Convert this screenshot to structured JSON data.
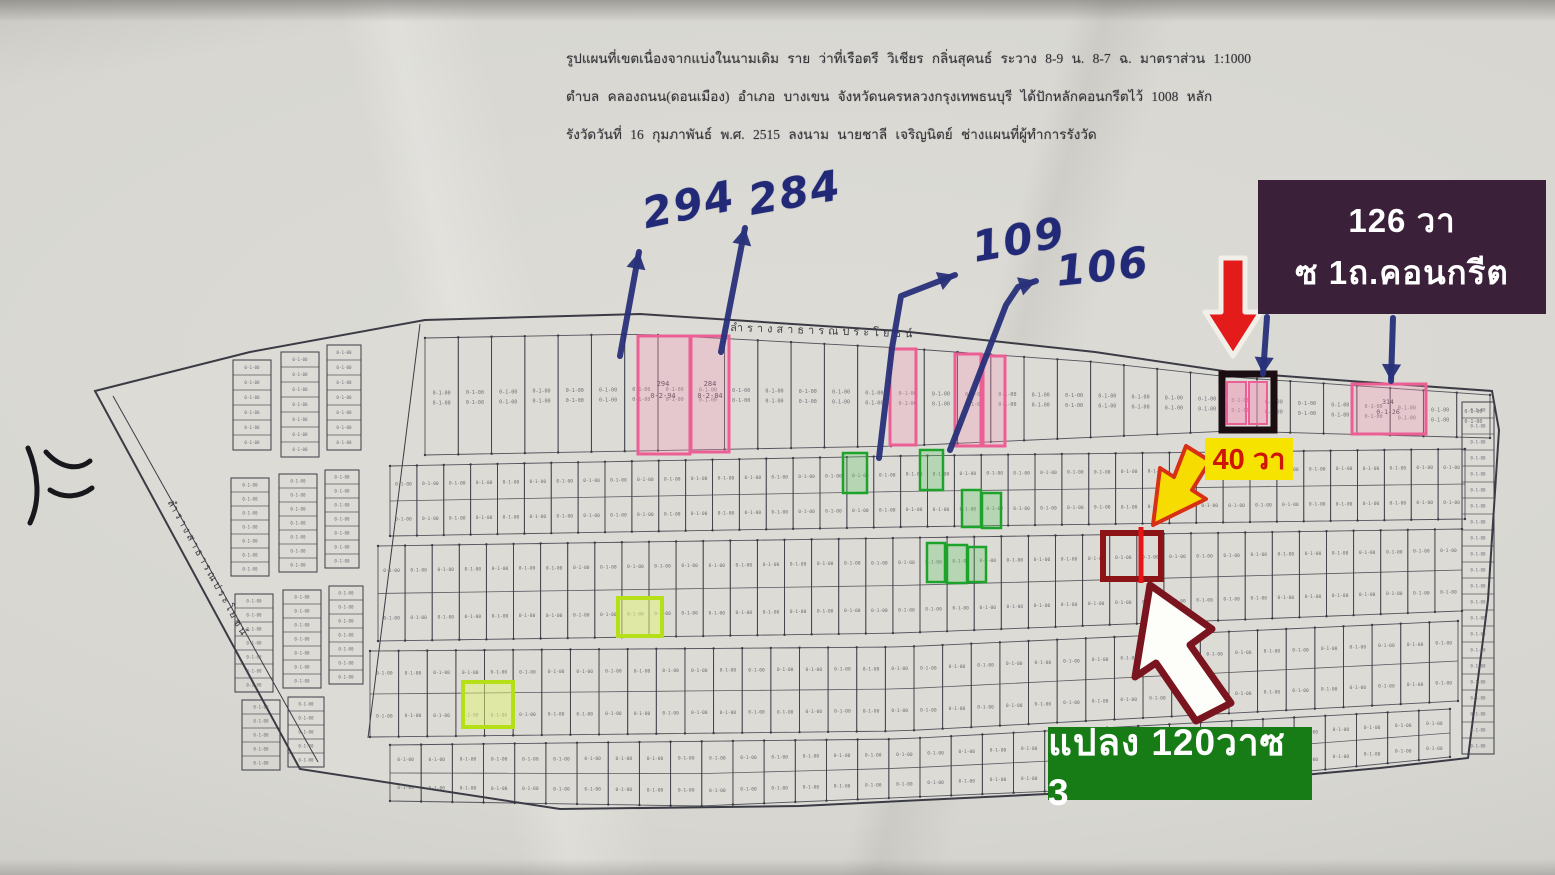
{
  "header": {
    "line1": "รูปแผนที่เขตเนื่องจากแบ่งในนามเดิม ราย ว่าที่เรือตรี วิเชียร กลิ่นสุคนธ์ ระวาง 8-9 น. 8-7 ฉ. มาตราส่วน 1:1000",
    "line2": "ตำบล คลองถนน(ดอนเมือง) อำเภอ บางเขน จังหวัดนครหลวงกรุงเทพธนบุรี ได้ปักหลักคอนกรีตไว้ 1008 หลัก",
    "line3": "รังวัดวันที่ 16 กุมภาพันธ์ พ.ศ. 2515 ลงนาม นายชาลี เจริญนิตย์ ช่างแผนที่ผู้ทำการรังวัด"
  },
  "map": {
    "road_label_top": "ลำรางสาธารณประโยชน์",
    "road_label_left": "ลำรางสาธารณประโยชน์",
    "plot_area_sample": "0-1-00",
    "colors": {
      "map_fill": "#dcdbd5",
      "line": "#3b3b45",
      "tiny_text": "#50505a",
      "pink": "#ec5f94",
      "pink_fill": "rgba(247,154,190,0.30)",
      "green": "#1da32c",
      "green_fill": "rgba(85,200,95,0.28)",
      "chartreuse": "#b5df17",
      "chartreuse_fill": "rgba(228,246,120,0.50)",
      "black_box": "#1a0e13",
      "dark_red": "#8c1316",
      "red": "#e31515",
      "blue_ink": "#283079",
      "scribble": "#17171c"
    },
    "boundary": [
      [
        95,
        391
      ],
      [
        250,
        352
      ],
      [
        425,
        320
      ],
      [
        640,
        314
      ],
      [
        900,
        331
      ],
      [
        1095,
        352
      ],
      [
        1230,
        372
      ],
      [
        1350,
        381
      ],
      [
        1492,
        391
      ],
      [
        1499,
        430
      ],
      [
        1488,
        600
      ],
      [
        1468,
        758
      ],
      [
        1380,
        768
      ],
      [
        1150,
        789
      ],
      [
        800,
        806
      ],
      [
        560,
        809
      ],
      [
        300,
        769
      ]
    ],
    "inner_lines": [
      {
        "d": "M113 396 L318 762"
      },
      {
        "d": "M420 324 L368 738"
      }
    ],
    "rows": [
      {
        "top": [
          [
            425,
            338
          ],
          [
            640,
            334
          ],
          [
            900,
            348
          ],
          [
            1095,
            362
          ],
          [
            1230,
            377
          ],
          [
            1490,
            395
          ]
        ],
        "bot": [
          [
            425,
            455
          ],
          [
            900,
            446
          ],
          [
            1230,
            431
          ],
          [
            1490,
            438
          ]
        ],
        "cols": 32,
        "split": false
      },
      {
        "top": [
          [
            390,
            466
          ],
          [
            900,
            456
          ],
          [
            1465,
            449
          ]
        ],
        "bot": [
          [
            390,
            536
          ],
          [
            900,
            527
          ],
          [
            1465,
            519
          ]
        ],
        "cols": 40,
        "split": true
      },
      {
        "top": [
          [
            378,
            546
          ],
          [
            900,
            538
          ],
          [
            1462,
            529
          ]
        ],
        "bot": [
          [
            378,
            641
          ],
          [
            900,
            633
          ],
          [
            1460,
            611
          ]
        ],
        "cols": 40,
        "split": true
      },
      {
        "top": [
          [
            370,
            651
          ],
          [
            900,
            647
          ],
          [
            1458,
            621
          ]
        ],
        "bot": [
          [
            370,
            737
          ],
          [
            900,
            731
          ],
          [
            1458,
            701
          ]
        ],
        "cols": 38,
        "split": true
      },
      {
        "top": [
          [
            390,
            745
          ],
          [
            900,
            739
          ],
          [
            1450,
            709
          ]
        ],
        "bot": [
          [
            390,
            801
          ],
          [
            700,
            806
          ],
          [
            1150,
            787
          ],
          [
            1450,
            757
          ]
        ],
        "cols": 34,
        "split": true
      }
    ],
    "stacks": [
      {
        "x": 233,
        "y": 360,
        "w": 38,
        "rows": 6,
        "rh": 15
      },
      {
        "x": 281,
        "y": 352,
        "w": 38,
        "rows": 7,
        "rh": 15
      },
      {
        "x": 327,
        "y": 345,
        "w": 34,
        "rows": 7,
        "rh": 15
      },
      {
        "x": 231,
        "y": 478,
        "w": 38,
        "rows": 7,
        "rh": 14
      },
      {
        "x": 279,
        "y": 474,
        "w": 38,
        "rows": 7,
        "rh": 14
      },
      {
        "x": 325,
        "y": 470,
        "w": 34,
        "rows": 7,
        "rh": 14
      },
      {
        "x": 235,
        "y": 594,
        "w": 38,
        "rows": 7,
        "rh": 14
      },
      {
        "x": 283,
        "y": 590,
        "w": 38,
        "rows": 7,
        "rh": 14
      },
      {
        "x": 329,
        "y": 586,
        "w": 34,
        "rows": 7,
        "rh": 14
      },
      {
        "x": 242,
        "y": 700,
        "w": 38,
        "rows": 5,
        "rh": 14
      },
      {
        "x": 288,
        "y": 697,
        "w": 36,
        "rows": 5,
        "rh": 14
      },
      {
        "x": 1462,
        "y": 402,
        "w": 32,
        "rows": 22,
        "rh": 16
      }
    ],
    "highlights": {
      "pink": [
        [
          638,
          336,
          52,
          118
        ],
        [
          691,
          336,
          38,
          116
        ],
        [
          890,
          349,
          26,
          96
        ],
        [
          955,
          354,
          26,
          92
        ],
        [
          983,
          356,
          22,
          90
        ],
        [
          1352,
          384,
          74,
          50
        ]
      ],
      "black_box": [
        1222,
        374,
        52,
        56
      ],
      "pink_in_black": [
        [
          1227,
          382,
          19,
          42
        ],
        [
          1249,
          382,
          18,
          42
        ]
      ],
      "green": [
        [
          843,
          453,
          24,
          40
        ],
        [
          920,
          450,
          23,
          40
        ],
        [
          962,
          490,
          19,
          37
        ],
        [
          982,
          493,
          19,
          35
        ],
        [
          927,
          543,
          18,
          39
        ],
        [
          947,
          545,
          20,
          38
        ],
        [
          968,
          547,
          18,
          35
        ]
      ],
      "chartreuse": [
        [
          618,
          598,
          44,
          38
        ],
        [
          463,
          682,
          50,
          45
        ]
      ],
      "dark_red_box": [
        1103,
        533,
        58,
        46
      ],
      "red_divider": {
        "x": 1141,
        "y1": 527,
        "y2": 583
      }
    },
    "blue_arrows": [
      {
        "pts": [
          [
            620,
            356
          ],
          [
            639,
            252
          ]
        ]
      },
      {
        "pts": [
          [
            721,
            352
          ],
          [
            745,
            228
          ]
        ]
      },
      {
        "pts": [
          [
            879,
            458
          ],
          [
            892,
            348
          ],
          [
            901,
            296
          ],
          [
            955,
            275
          ]
        ]
      },
      {
        "pts": [
          [
            950,
            450
          ],
          [
            1006,
            305
          ],
          [
            1018,
            287
          ],
          [
            1036,
            281
          ]
        ]
      },
      {
        "pts": [
          [
            1267,
            317
          ],
          [
            1263,
            374
          ]
        ]
      },
      {
        "pts": [
          [
            1393,
            318
          ],
          [
            1391,
            381
          ]
        ]
      }
    ],
    "marker_arrows": [
      {
        "name": "red-down-arrow",
        "d": "M1221 258 L1245 258 L1245 312 L1261 312 L1233 356 L1205 312 L1221 312 Z",
        "fill": "#e31b1b",
        "stroke": "#f2efe8",
        "sw": 5
      },
      {
        "name": "yellow-down-left-arrow",
        "d": "M1186 446 L1210 461 L1192 490 L1206 499 L1153 525 L1160 468 L1174 477 Z",
        "fill": "#f6dc00",
        "stroke": "#d83015",
        "sw": 4
      },
      {
        "name": "white-up-arrow",
        "d": "M1150 585 L1212 629 L1190 645 L1231 703 L1196 721 L1156 663 L1135 677 Z",
        "fill": "#fdfdfa",
        "stroke": "#7a141f",
        "sw": 7
      }
    ],
    "scribble": [
      "M28 448 C38 472 41 500 30 523",
      "M46 452 C60 468 78 471 90 461",
      "M50 490 C64 499 80 497 92 488"
    ]
  },
  "annotations": {
    "handwritten": [
      {
        "text": "294"
      },
      {
        "text": "284"
      },
      {
        "text": "109"
      },
      {
        "text": "106"
      }
    ],
    "plot_labels": {
      "p294": {
        "num": "294",
        "area": "0-2-94"
      },
      "p284": {
        "num": "284",
        "area": "0-2-84"
      },
      "p314": {
        "num": "314",
        "area": "0-1-26"
      }
    },
    "callouts": {
      "dark_box": {
        "line1": "126 วา",
        "line2": "ซ 1ถ.คอนกรีต"
      },
      "yellow_tag": {
        "text": "40 วา"
      },
      "green_tag": {
        "text": "แปลง 120วาซ 3"
      }
    }
  }
}
